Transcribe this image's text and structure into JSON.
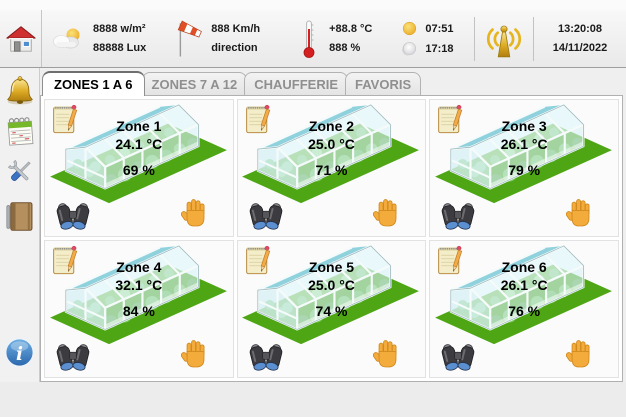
{
  "header": {
    "radiation_value": "8888 w/m²",
    "lux_value": "88888 Lux",
    "wind_speed": "888 Km/h",
    "wind_direction_label": "direction",
    "outside_temperature": "+88.8 °C",
    "outside_humidity": "888 %",
    "sunrise_time": "07:51",
    "sunset_time": "17:18",
    "clock_time": "13:20:08",
    "clock_date": "14/11/2022"
  },
  "tabs": [
    {
      "label": "ZONES 1 A 6",
      "active": true
    },
    {
      "label": "ZONES 7 A 12",
      "active": false
    },
    {
      "label": "CHAUFFERIE",
      "active": false
    },
    {
      "label": "FAVORIS",
      "active": false
    }
  ],
  "zones": [
    {
      "name": "Zone 1",
      "temperature": "24.1 °C",
      "humidity": "69 %"
    },
    {
      "name": "Zone 2",
      "temperature": "25.0 °C",
      "humidity": "71 %"
    },
    {
      "name": "Zone 3",
      "temperature": "26.1 °C",
      "humidity": "79 %"
    },
    {
      "name": "Zone 4",
      "temperature": "32.1 °C",
      "humidity": "84 %"
    },
    {
      "name": "Zone 5",
      "temperature": "25.0 °C",
      "humidity": "74 %"
    },
    {
      "name": "Zone 6",
      "temperature": "26.1 °C",
      "humidity": "76 %"
    }
  ],
  "sidebar": {
    "info_label": "i"
  },
  "icons": {
    "home": "house-icon",
    "radiation": "sun-cloud-icon",
    "wind": "windsock-icon",
    "temperature": "thermometer-icon",
    "sunrise": "sun-icon",
    "sunset": "moon-icon",
    "alarm_transmitter": "antenna-icon",
    "sidebar": [
      "bell-icon",
      "calendar-icon",
      "tools-icon",
      "notebook-icon",
      "info-icon"
    ],
    "zone_card": [
      "notepad-icon",
      "greenhouse-icon",
      "binoculars-icon",
      "hand-icon"
    ]
  },
  "colors": {
    "grass_green": "#4ea614",
    "glass_blue": "#d8f1f5",
    "roof_teal": "#8fd2dd",
    "hand_orange": "#f3ab3c",
    "bell_gold": "#d9a41f",
    "info_blue": "#2f6fba",
    "active_tab_text": "#000000",
    "inactive_tab_text": "#8f8f8f"
  }
}
